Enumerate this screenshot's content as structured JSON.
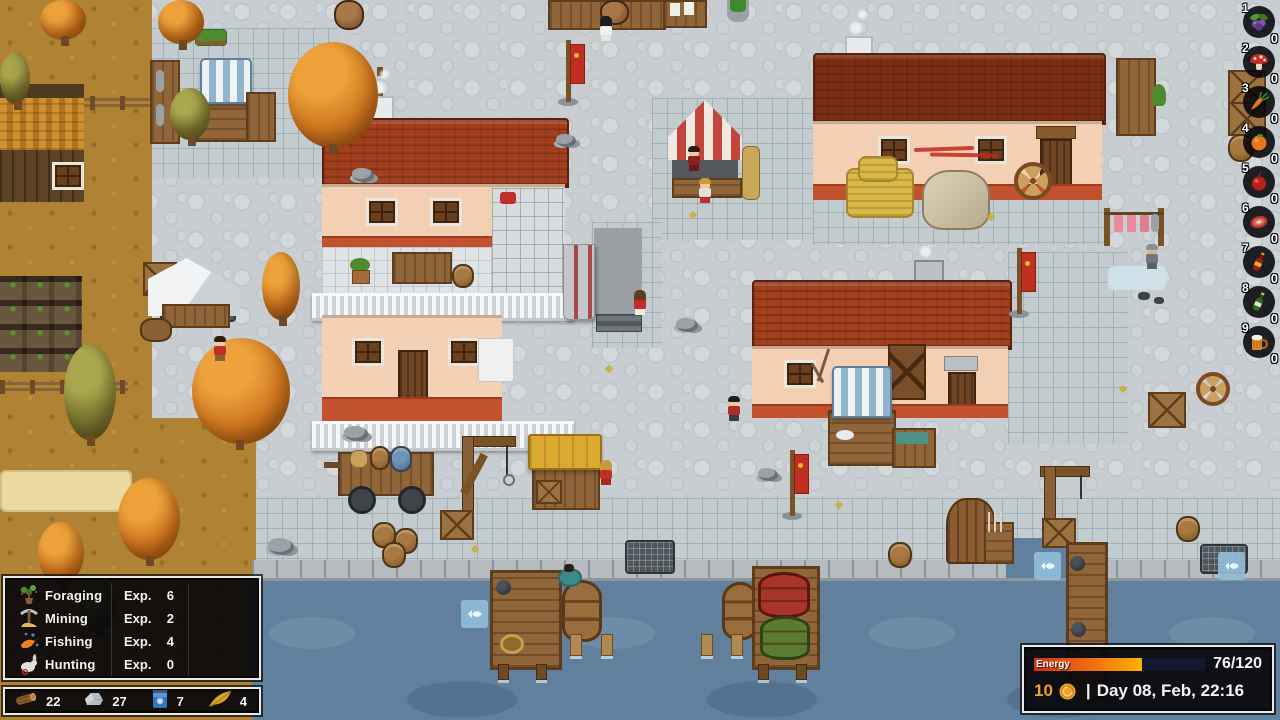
{
  "hud": {
    "skills_panel": {
      "rows": [
        {
          "skill": "Foraging",
          "exp_label": "Exp.",
          "exp_value": "6",
          "icon": "sapling-icon"
        },
        {
          "skill": "Mining",
          "exp_label": "Exp.",
          "exp_value": "2",
          "icon": "pickaxe-icon"
        },
        {
          "skill": "Fishing",
          "exp_label": "Exp.",
          "exp_value": "4",
          "icon": "fishing-icon"
        },
        {
          "skill": "Hunting",
          "exp_label": "Exp.",
          "exp_value": "0",
          "icon": "rabbit-icon"
        }
      ]
    },
    "resources_bar": {
      "items": [
        {
          "icon": "wood-log-icon",
          "count": "22"
        },
        {
          "icon": "stone-icon",
          "count": "27"
        },
        {
          "icon": "blue-pouch-icon",
          "count": "7"
        },
        {
          "icon": "feather-icon",
          "count": "4"
        }
      ]
    },
    "status_panel": {
      "energy_label": "Energy",
      "energy_value": "76/120",
      "energy_current": 76,
      "energy_max": 120,
      "coins": "10",
      "separator": "|",
      "datetime": "Day 08, Feb, 22:16",
      "colors": {
        "energy_gradient_start": "#d62f10",
        "energy_gradient_end": "#ffb200",
        "coin": "#f0a62e",
        "coins_text": "#f0a030"
      }
    },
    "hotbar": {
      "slots": [
        {
          "number": "1",
          "item": "berries",
          "count": "0"
        },
        {
          "number": "2",
          "item": "mushroom",
          "count": "0"
        },
        {
          "number": "3",
          "item": "carrot",
          "count": "0"
        },
        {
          "number": "4",
          "item": "orange-fruit",
          "count": "0"
        },
        {
          "number": "5",
          "item": "apple",
          "count": "0"
        },
        {
          "number": "6",
          "item": "meat",
          "count": "0"
        },
        {
          "number": "7",
          "item": "wine-bottle",
          "count": "0"
        },
        {
          "number": "8",
          "item": "champagne-bottle",
          "count": "0"
        },
        {
          "number": "9",
          "item": "beer-mug",
          "count": "0"
        }
      ]
    }
  }
}
